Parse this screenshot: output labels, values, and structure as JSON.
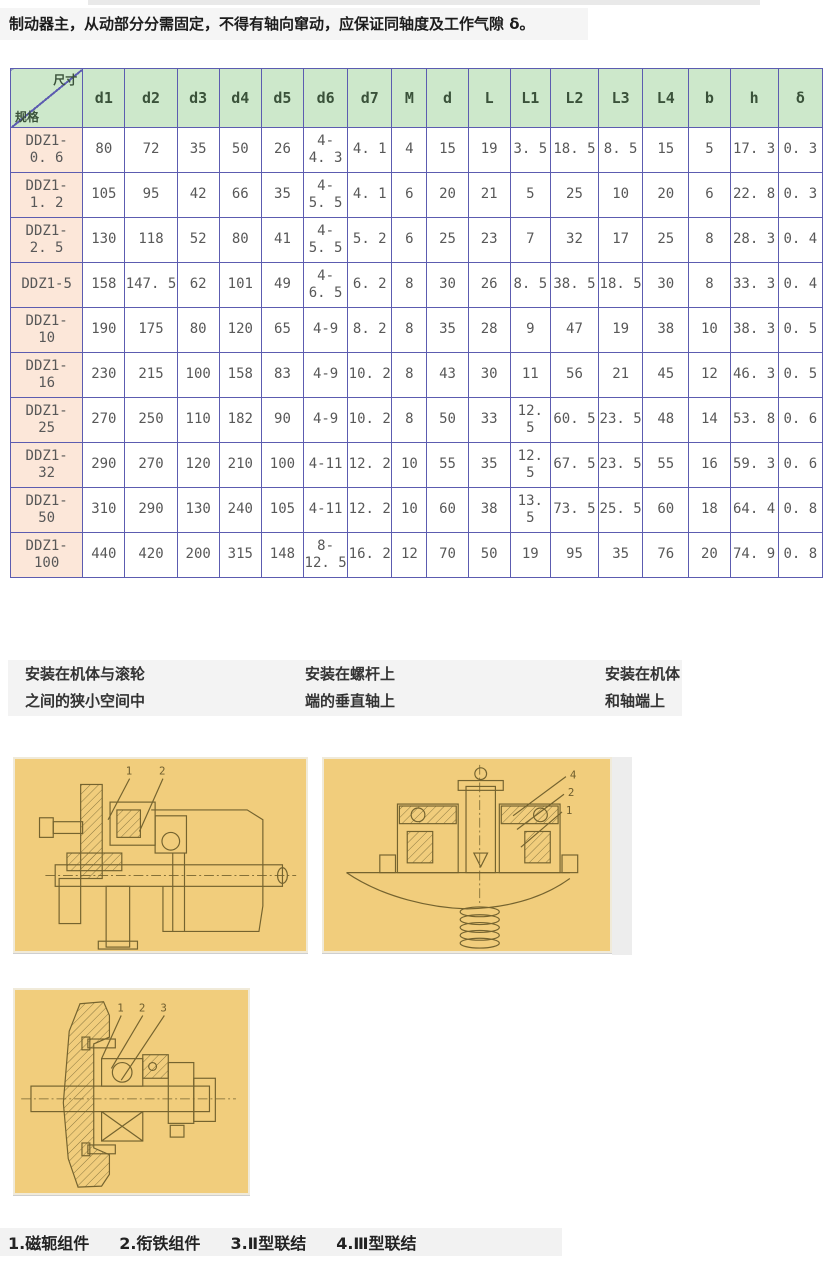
{
  "page": {
    "intro_text": "制动器主，从动部分分需固定，不得有轴向窜动，应保证同轴度及工作气隙 δ。"
  },
  "table": {
    "corner": {
      "top_right": "尺寸",
      "bottom_left": "规格"
    },
    "columns": [
      "d1",
      "d2",
      "d3",
      "d4",
      "d5",
      "d6",
      "d7",
      "M",
      "d",
      "L",
      "L1",
      "L2",
      "L3",
      "L4",
      "b",
      "h",
      "δ"
    ],
    "rows": [
      {
        "spec": "DDZ1-\n0. 6",
        "values": [
          "80",
          "72",
          "35",
          "50",
          "26",
          "4-\n4. 3",
          "4. 1",
          "4",
          "15",
          "19",
          "3. 5",
          "18. 5",
          "8. 5",
          "15",
          "5",
          "17. 3",
          "0. 3"
        ]
      },
      {
        "spec": "DDZ1-\n1. 2",
        "values": [
          "105",
          "95",
          "42",
          "66",
          "35",
          "4-\n5. 5",
          "4. 1",
          "6",
          "20",
          "21",
          "5",
          "25",
          "10",
          "20",
          "6",
          "22. 8",
          "0. 3"
        ]
      },
      {
        "spec": "DDZ1-\n2. 5",
        "values": [
          "130",
          "118",
          "52",
          "80",
          "41",
          "4-\n5. 5",
          "5. 2",
          "6",
          "25",
          "23",
          "7",
          "32",
          "17",
          "25",
          "8",
          "28. 3",
          "0. 4"
        ]
      },
      {
        "spec": "DDZ1-5",
        "values": [
          "158",
          "147. 5",
          "62",
          "101",
          "49",
          "4-\n6. 5",
          "6. 2",
          "8",
          "30",
          "26",
          "8. 5",
          "38. 5",
          "18. 5",
          "30",
          "8",
          "33. 3",
          "0. 4"
        ]
      },
      {
        "spec": "DDZ1-\n10",
        "values": [
          "190",
          "175",
          "80",
          "120",
          "65",
          "4-9",
          "8. 2",
          "8",
          "35",
          "28",
          "9",
          "47",
          "19",
          "38",
          "10",
          "38. 3",
          "0. 5"
        ]
      },
      {
        "spec": "DDZ1-\n16",
        "values": [
          "230",
          "215",
          "100",
          "158",
          "83",
          "4-9",
          "10. 2",
          "8",
          "43",
          "30",
          "11",
          "56",
          "21",
          "45",
          "12",
          "46. 3",
          "0. 5"
        ]
      },
      {
        "spec": "DDZ1-\n25",
        "values": [
          "270",
          "250",
          "110",
          "182",
          "90",
          "4-9",
          "10. 2",
          "8",
          "50",
          "33",
          "12. 5",
          "60. 5",
          "23. 5",
          "48",
          "14",
          "53. 8",
          "0. 6"
        ]
      },
      {
        "spec": "DDZ1-\n32",
        "values": [
          "290",
          "270",
          "120",
          "210",
          "100",
          "4-11",
          "12. 2",
          "10",
          "55",
          "35",
          "12. 5",
          "67. 5",
          "23. 5",
          "55",
          "16",
          "59. 3",
          "0. 6"
        ]
      },
      {
        "spec": "DDZ1-\n50",
        "values": [
          "310",
          "290",
          "130",
          "240",
          "105",
          "4-11",
          "12. 2",
          "10",
          "60",
          "38",
          "13. 5",
          "73. 5",
          "25. 5",
          "60",
          "18",
          "64. 4",
          "0. 8"
        ]
      },
      {
        "spec": "DDZ1-\n100",
        "values": [
          "440",
          "420",
          "200",
          "315",
          "148",
          "8-\n12. 5",
          "16. 2",
          "12",
          "70",
          "50",
          "19",
          "95",
          "35",
          "76",
          "20",
          "74. 9",
          "0. 8"
        ]
      }
    ]
  },
  "captions": [
    {
      "line1": "安装在机体与滚轮",
      "line2": "之间的狭小空间中"
    },
    {
      "line1": "安装在螺杆上",
      "line2": "端的垂直轴上"
    },
    {
      "line1": "安装在机体",
      "line2": "和轴端上"
    }
  ],
  "figures": [
    {
      "labels": [
        "1",
        "2"
      ]
    },
    {
      "labels": [
        "4",
        "2",
        "1"
      ]
    },
    {
      "labels": [
        "1",
        "2",
        "3"
      ]
    }
  ],
  "legend": {
    "items": [
      "1.磁轭组件",
      "2.衔铁组件",
      "3.Ⅱ型联结",
      "4.Ⅲ型联结"
    ]
  },
  "colors": {
    "table_border": "#5c5cb0",
    "header_green": "#cde8cb",
    "spec_pink": "#fce7d9",
    "figure_background": "#f1cd7c",
    "figure_line": "#74632f",
    "strip_gray": "#f3f3f3"
  }
}
